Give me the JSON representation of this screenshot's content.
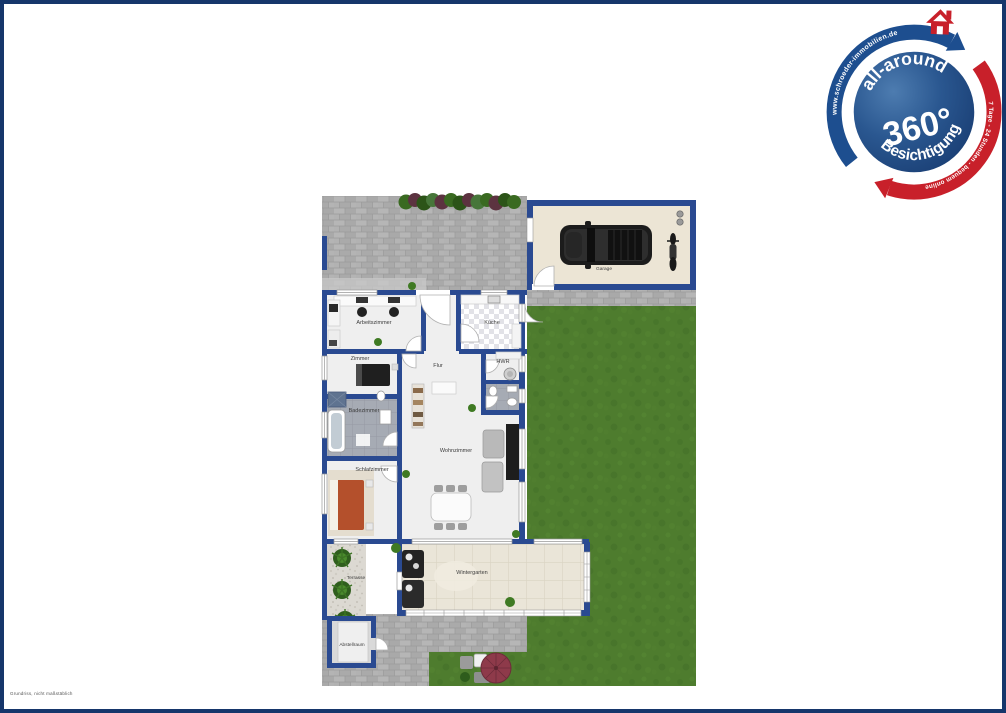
{
  "rooms": {
    "garage": "Garage",
    "arbeitszimmer": "Arbeitszimmer",
    "kueche": "Küche",
    "zimmer": "Zimmer",
    "flur": "Flur",
    "hwr": "HWR",
    "badezimmer": "Badezimmer",
    "wohnzimmer": "Wohnzimmer",
    "schlafzimmer": "Schlafzimmer",
    "wintergarten": "Wintergarten",
    "terrasse": "Terrasse",
    "abstellraum": "Abstellraum"
  },
  "badge": {
    "line1": "all-around",
    "line2": "360°",
    "line3": "Besichtigung",
    "arrow_blue_text": "www.schroeder-immobilien.de",
    "arrow_red_text": "7 Tage - 24 Stunden - bequem online"
  },
  "footer": {
    "disclaimer": "Grundriss, nicht maßstäblich"
  },
  "colors": {
    "frame": "#16366b",
    "wall": "#2a4a91",
    "lawn": "#4e7c2e",
    "pavement": "#afafaf",
    "garage_floor": "#ece5d5",
    "badge_blue": "#1d4e8f",
    "badge_red": "#c8202a",
    "bed": "#b4502c",
    "parasol": "#8e3a4a"
  }
}
